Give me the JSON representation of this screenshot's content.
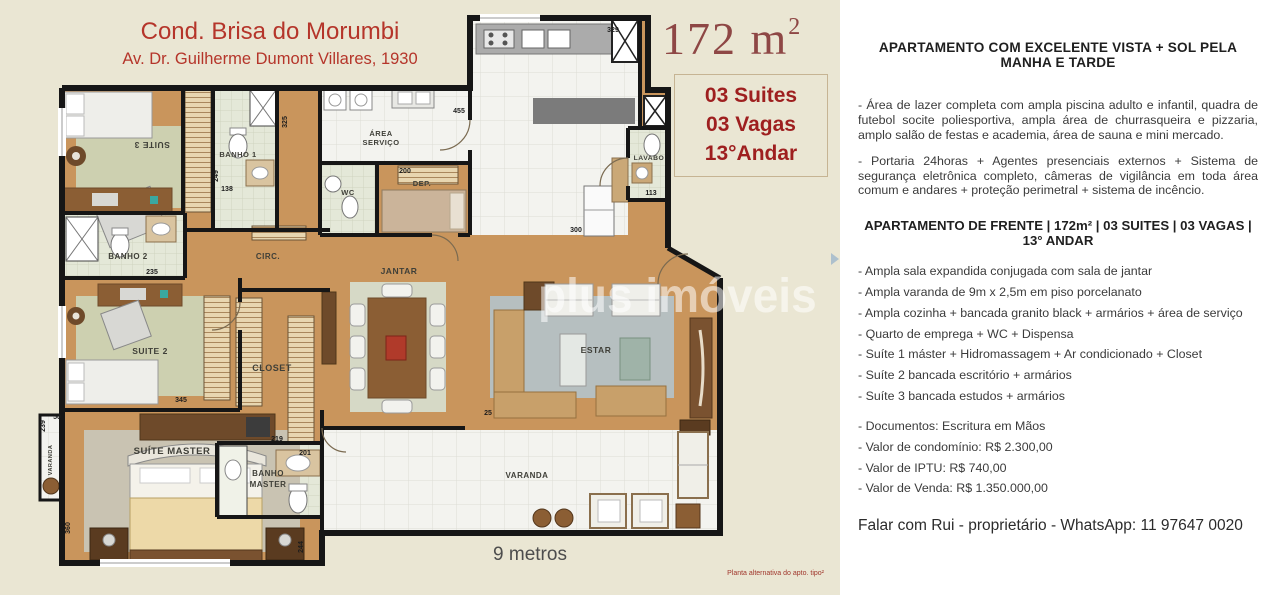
{
  "left_panel": {
    "title": "Cond. Brisa do Morumbi",
    "address": "Av. Dr. Guilherme Dumont Villares, 1930",
    "area_main": "172 m",
    "area_sup": "2",
    "facts": [
      "03 Suites",
      "03 Vagas",
      "13°Andar"
    ],
    "watermark": "plus imóveis",
    "scale_note": "9 metros",
    "footnote": "Planta alternativa do apto. tipo²",
    "colors": {
      "background": "#eae6d3",
      "frame": "#a58d6d",
      "title_red": "#b5352a",
      "area_red": "#8e4745",
      "facts_red": "#9e1f1f",
      "wall": "#161616",
      "wood_floor": "#c9955c",
      "bath_floor": "#e4e8d8",
      "rug_olive": "#cdd0b0",
      "rug_gray": "#b6bfc0"
    }
  },
  "floorplan": {
    "room_labels": {
      "suite3": "SUITE 3",
      "banho1": "BANHO 1",
      "area_servico_1": "ÁREA",
      "area_servico_2": "SERVIÇO",
      "wc": "WC",
      "dep": "DEP.",
      "lavabo": "LAVABO",
      "circ": "CIRC.",
      "banho2": "BANHO 2",
      "suite2": "SUITE 2",
      "closet": "CLOSET",
      "jantar": "JANTAR",
      "estar": "ESTAR",
      "suite_master": "SUÍTE MASTER",
      "banho_master_1": "BANHO",
      "banho_master_2": "MASTER",
      "varanda": "VARANDA",
      "varanda_left": "VARANDA"
    },
    "dims": [
      "455",
      "329",
      "200",
      "300",
      "113",
      "138",
      "249",
      "235",
      "325",
      "345",
      "25",
      "219",
      "201",
      "244",
      "360",
      "239",
      "50"
    ]
  },
  "right_panel": {
    "heading1": "APARTAMENTO COM EXCELENTE VISTA  +  SOL PELA MANHA E TARDE",
    "para1": "- Área de lazer completa com ampla piscina  adulto e infantil, quadra de futebol socite poliesportiva, ampla área de churrasqueira e pizzaria, amplo salão de festas e academia, área de sauna e mini mercado.",
    "para2": "- Portaria 24horas + Agentes presenciais externos + Sistema de segurança eletrônica completo, câmeras de vigilância em toda área comum e andares + proteção perimetral + sistema de incêncio.",
    "heading2": "APARTAMENTO DE FRENTE  | 172m² | 03 SUITES | 03 VAGAS | 13° ANDAR",
    "bullets": [
      "- Ampla sala expandida conjugada com sala de jantar",
      "- Ampla varanda de 9m x 2,5m em piso porcelanato",
      "- Ampla cozinha + bancada granito black + armários + área de serviço",
      "- Quarto de emprega + WC + Dispensa",
      "- Suíte 1 máster + Hidromassagem + Ar condicionado + Closet",
      "- Suíte 2  bancada escritório + armários",
      "- Suíte 3  bancada estudos + armários"
    ],
    "details": [
      "- Documentos: Escritura em Mãos",
      "- Valor de condomínio: R$  2.300,00",
      "- Valor de IPTU: R$ 740,00",
      "- Valor de Venda: R$ 1.350.000,00"
    ],
    "contact": "Falar com Rui - proprietário   -   WhatsApp: 11 97647 0020"
  }
}
